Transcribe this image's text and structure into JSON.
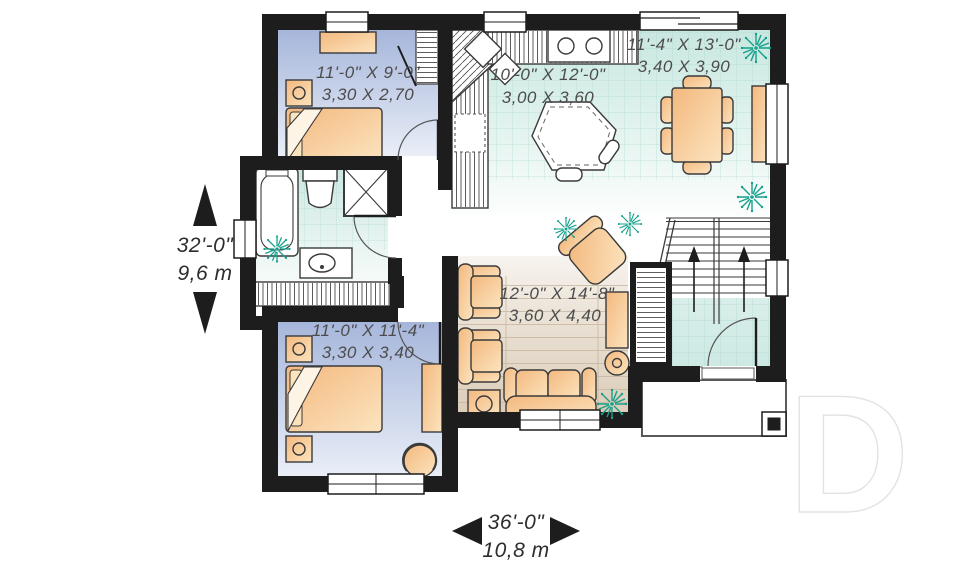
{
  "plan": {
    "rooms": [
      {
        "name": "bedroom-1",
        "imperial": "11'-0\" X 9'-0\"",
        "metric": "3,30 X 2,70"
      },
      {
        "name": "kitchen",
        "imperial": "10'-0\" X 12'-0\"",
        "metric": "3,00 X 3,60"
      },
      {
        "name": "dining-room",
        "imperial": "11'-4\" X 13'-0\"",
        "metric": "3,40 X 3,90"
      },
      {
        "name": "living-room",
        "imperial": "12'-0\" X 14'-8\"",
        "metric": "3,60 X 4,40"
      },
      {
        "name": "bedroom-2",
        "imperial": "11'-0\" X 11'-4\"",
        "metric": "3,30 X 3,40"
      }
    ],
    "overall_depth": {
      "imperial": "32'-0\"",
      "metric": "9,6 m"
    },
    "overall_width": {
      "imperial": "36'-0\"",
      "metric": "10,8 m"
    },
    "watermark": "D",
    "colors": {
      "wall": "#1d1d1d",
      "tile_floor": "#c8e7e0",
      "bedroom_floor": "#a6b6db",
      "wood_floor": "#ddcfbc",
      "furniture": "#f3b87e",
      "plant": "#14a08b"
    }
  }
}
